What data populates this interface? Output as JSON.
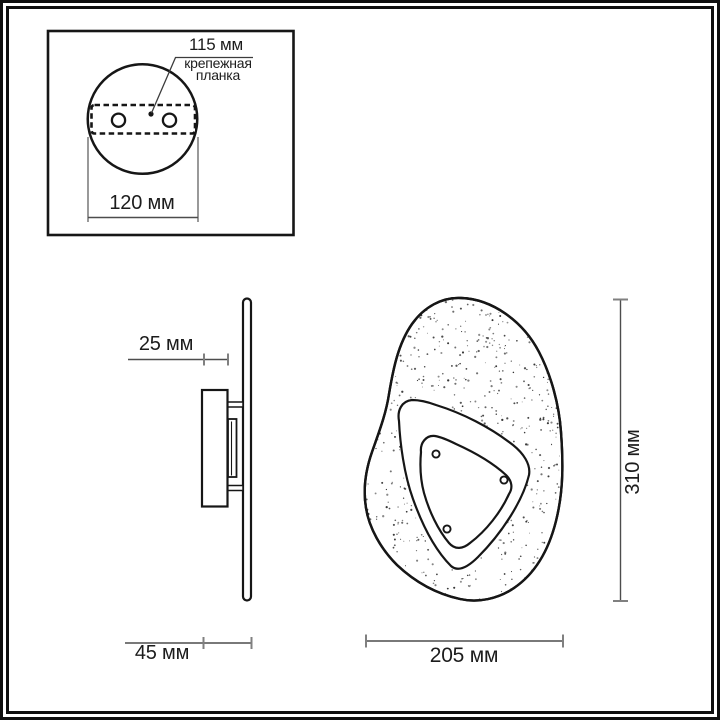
{
  "colors": {
    "background": "#ffffff",
    "drawing_line": "#161616",
    "dimension_line": "#4d4d4d",
    "dimension_tick": "#808080",
    "text": "#1c1c1c"
  },
  "mounting_inset": {
    "hole_spacing_label": "115 мм",
    "bracket_label_line1": "крепежная",
    "bracket_label_line2": "планка",
    "diameter_label": "120 мм"
  },
  "side_view": {
    "plate_depth_label": "25 мм",
    "total_depth_label": "45 мм"
  },
  "front_view": {
    "width_label": "205 мм",
    "height_label": "310 мм"
  }
}
